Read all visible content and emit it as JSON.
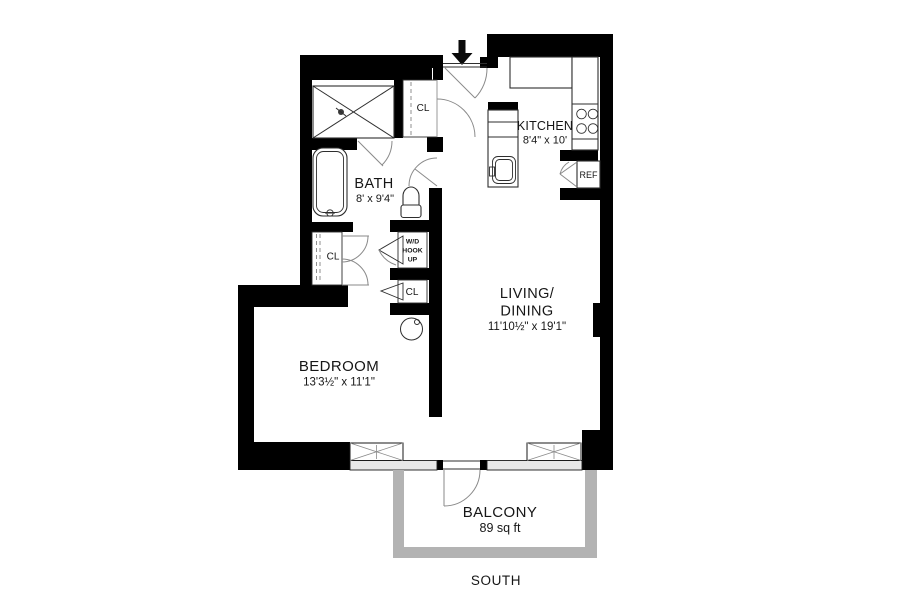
{
  "plan": {
    "rooms": {
      "bath": {
        "label": "BATH",
        "dims": "8' x 9'4\""
      },
      "kitchen": {
        "label": "KITCHEN",
        "dims": "8'4\" x 10'"
      },
      "living": {
        "label_line1": "LIVING/",
        "label_line2": "DINING",
        "dims": "11'10½\" x 19'1\""
      },
      "bedroom": {
        "label": "BEDROOM",
        "dims": "13'3½\" x 11'1\""
      },
      "balcony": {
        "label": "BALCONY",
        "area": "89 sq ft"
      }
    },
    "labels": {
      "closet_entry": "CL",
      "closet_bedroom": "CL",
      "closet_hall": "CL",
      "wd_line1": "W/D",
      "wd_line2": "HOOK",
      "wd_line3": "UP",
      "refrigerator": "REF",
      "compass_direction": "SOUTH"
    },
    "colors": {
      "wall": "#000000",
      "rail": "#b3b3b3",
      "sill": "#e8e8e8",
      "line": "#444444",
      "text": "#161616"
    }
  }
}
